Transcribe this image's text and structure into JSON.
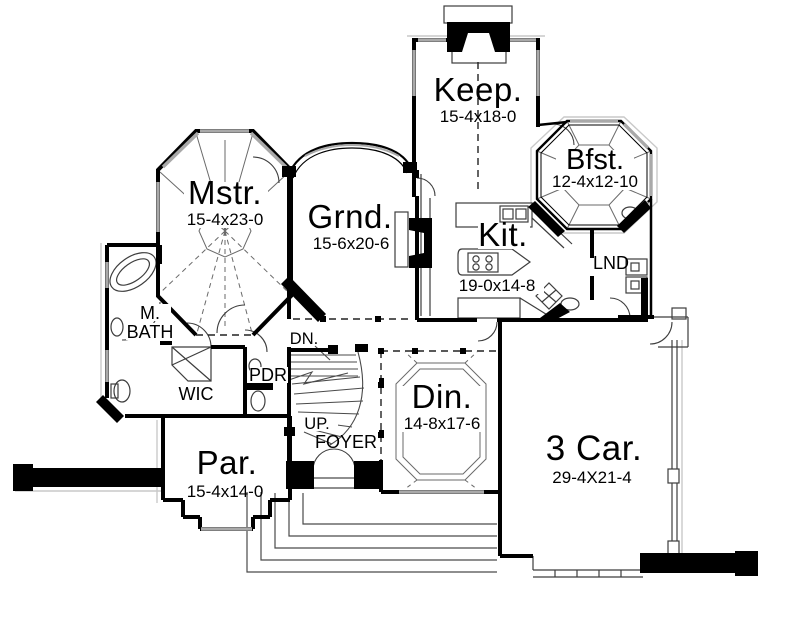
{
  "drawing": {
    "background": "#ffffff",
    "wall_color": "#000000",
    "window_color": "#a9a9a9"
  },
  "rooms": {
    "keep": {
      "label": "Keep.",
      "dims": "15-4x18-0"
    },
    "bfst": {
      "label": "Bfst.",
      "dims": "12-4x12-10"
    },
    "mstr": {
      "label": "Mstr.",
      "dims": "15-4x23-0"
    },
    "grnd": {
      "label": "Grnd.",
      "dims": "15-6x20-6"
    },
    "kit": {
      "label": "Kit.",
      "dims": "19-0x14-8"
    },
    "din": {
      "label": "Din.",
      "dims": "14-8x17-6"
    },
    "par": {
      "label": "Par.",
      "dims": "15-4x14-0"
    },
    "car": {
      "label": "3 Car.",
      "dims": "29-4X21-4"
    },
    "lnd": {
      "label": "LND"
    },
    "mbath": {
      "label_line1": "M.",
      "label_line2": "BATH"
    },
    "wic": {
      "label": "WIC"
    },
    "pdr": {
      "label": "PDR"
    },
    "foyer": {
      "label": "FOYER"
    },
    "stair_down": {
      "label": "DN."
    },
    "stair_up": {
      "label": "UP."
    }
  }
}
